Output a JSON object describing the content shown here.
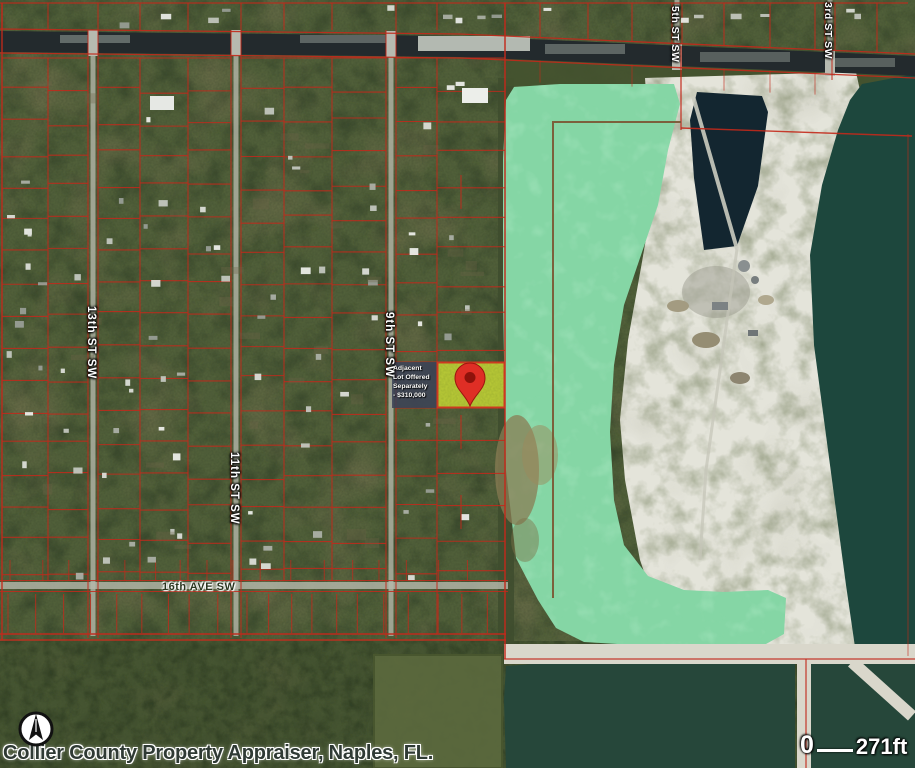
{
  "attribution": {
    "text": "Collier County Property Appraiser, Naples, FL."
  },
  "scale_bar": {
    "zero_label": "0",
    "distance_label": "271ft"
  },
  "street_labels": {
    "st13": "13th ST SW",
    "st11": "11th ST SW",
    "st9": "9th ST SW",
    "st5": "5th ST SW",
    "st3": "3rd ST SW",
    "ave16": "16th AVE SW"
  },
  "listing_note": {
    "line1": "Adjacent",
    "line2": "Lot Offered",
    "line3": "Separately",
    "line4": "- $310,000"
  },
  "marker": {
    "icon": "location-pin"
  },
  "compass": {
    "icon": "north-arrow"
  },
  "colors": {
    "terrain": "#51603a",
    "parcel_line": "#c3291b",
    "canal": "#232a2d",
    "mint_lake": "#85d6a5",
    "quarry_pond": "#132630",
    "east_lake": "#1d473d",
    "south_lake": "#26473a",
    "sand": "#e4e4da",
    "road": "#b6b9ac",
    "subject_fill": "#b5c636",
    "subject_border": "#d23420",
    "pin_red": "#df2e25",
    "pin_hole": "#8e120b",
    "boundary_brown": "#7b5a36"
  }
}
